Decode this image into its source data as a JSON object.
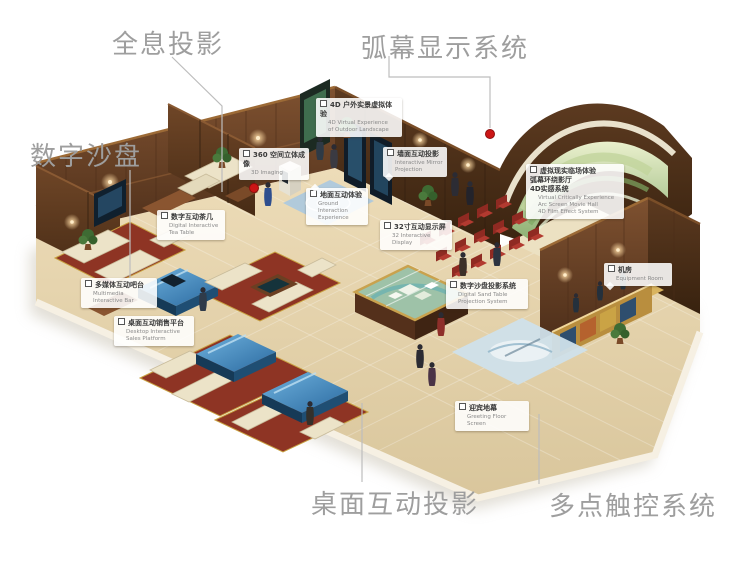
{
  "main_labels": [
    {
      "id": "holographic-projection",
      "text": "全息投影"
    },
    {
      "id": "arc-screen-display-system",
      "text": "弧幕显示系统"
    },
    {
      "id": "digital-sand-table",
      "text": "数字沙盘"
    },
    {
      "id": "desktop-interactive-projection",
      "text": "桌面互动投影"
    },
    {
      "id": "multi-touch-system",
      "text": "多点触控系统"
    }
  ],
  "callouts": [
    {
      "zh": "4D 户外实景虚拟体验",
      "en": "4D Virtual Experience\nof Outdoor Landscape"
    },
    {
      "zh": "360 空间立体成像",
      "en": "3D Imaging"
    },
    {
      "zh": "墙面互动投影",
      "en": "Interactive Mirror\nProjection"
    },
    {
      "zh": "地面互动体验",
      "en": "Ground Interaction\nExperience"
    },
    {
      "zh": "数字互动茶几",
      "en": "Digital Interactive\nTea Table"
    },
    {
      "zh": "多媒体互动吧台",
      "en": "Multimedia\nInteractive Bar"
    },
    {
      "zh": "桌面互动销售平台",
      "en": "Desktop Interactive\nSales Platform"
    },
    {
      "zh": "32寸互动显示屏",
      "en": "32 Interactive Display"
    },
    {
      "zh": "虚拟现实临场体验\n弧幕环绕影厅\n4D实感系统",
      "en": "Virtual Critically Experience\nArc Screen Movie Hall\n4D Film Effect System"
    },
    {
      "zh": "机房",
      "en": "Equipment Room"
    },
    {
      "zh": "数字沙盘投影系统",
      "en": "Digital Sand Table\nProjection System"
    },
    {
      "zh": "迎宾地幕",
      "en": "Greeting Floor Screen"
    }
  ],
  "icons": {
    "callout_marker": "checkbox-icon",
    "hotspot": "red-dot"
  },
  "colors": {
    "label_gray": "#9e9e9e",
    "leader_line_gray": "#bdbdbd",
    "hotspot_red": "#cc1616",
    "wood_dark": "#5a3620",
    "floor_beige": "#e6d7b2",
    "screen_blue": "#3f87c0",
    "carpet_red": "#8e3424",
    "dome_green": "#a9c48c"
  }
}
